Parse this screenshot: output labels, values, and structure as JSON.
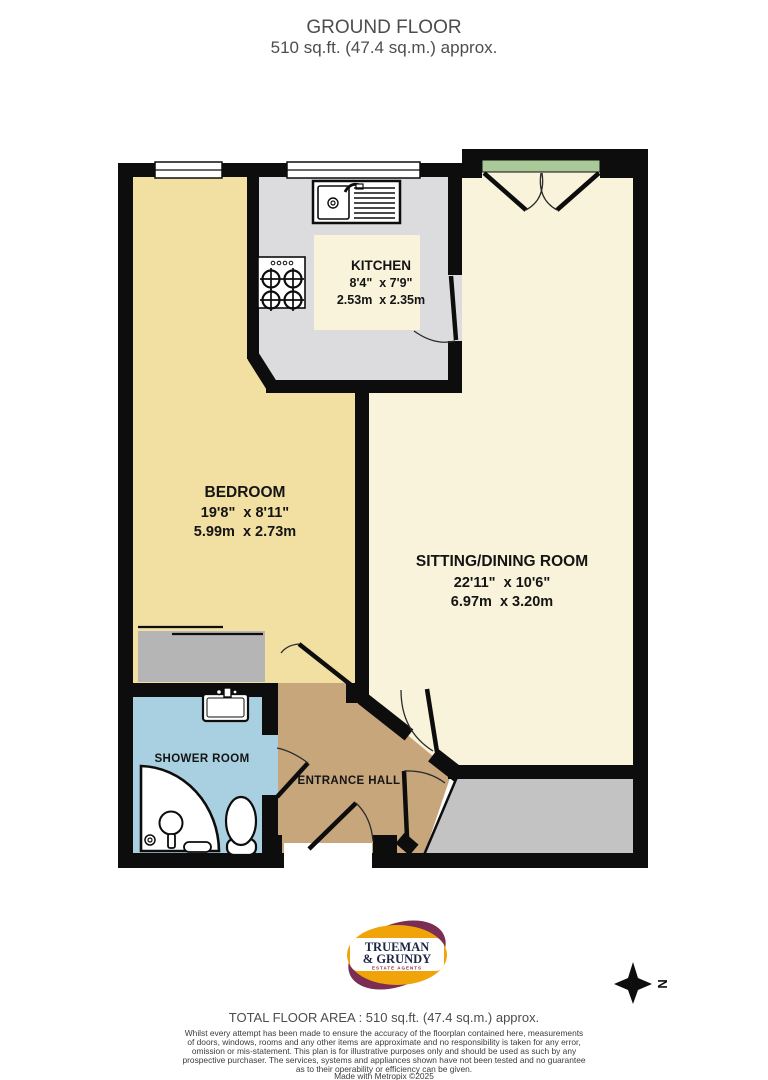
{
  "title": {
    "line1": "GROUND FLOOR",
    "line2": "510 sq.ft. (47.4 sq.m.) approx."
  },
  "rooms": {
    "kitchen": {
      "name": "KITCHEN",
      "imperial": "8'4\"  x 7'9\"",
      "metric": "2.53m  x 2.35m"
    },
    "bedroom": {
      "name": "BEDROOM",
      "imperial": "19'8\"  x 8'11\"",
      "metric": "5.99m  x 2.73m"
    },
    "sitting": {
      "name": "SITTING/DINING ROOM",
      "imperial": "22'11\"  x 10'6\"",
      "metric": "6.97m  x 3.20m"
    },
    "shower": {
      "name": "SHOWER ROOM"
    },
    "hall": {
      "name": "ENTRANCE HALL"
    }
  },
  "compass": {
    "label": "N"
  },
  "logo": {
    "name_line1": "TRUEMAN",
    "name_line2": "& GRUNDY",
    "tagline": "ESTATE AGENTS"
  },
  "footer": {
    "total_area": "TOTAL FLOOR AREA : 510 sq.ft. (47.4 sq.m.) approx.",
    "disclaimer": [
      "Whilst every attempt has been made to ensure the accuracy of the floorplan contained here, measurements",
      "of doors, windows, rooms and any other items are approximate and no responsibility is taken for any error,",
      "omission or mis-statement. This plan is for illustrative purposes only and should be used as such by any",
      "prospective purchaser. The services, systems and appliances shown have not been tested and no guarantee",
      "as to their operability or efficiency can be given."
    ],
    "credit": "Made with Metropix ©2025"
  },
  "colors": {
    "wall": "#0d0d0d",
    "bedroom_floor": "#f2dfa2",
    "sitting_floor": "#f8f3da",
    "kitchen_counter": "#dcdcdf",
    "kitchen_floor": "#f8f3da",
    "shower_floor": "#a9d0e0",
    "hall_floor": "#c8a67c",
    "storage_gray": "#c3c3c4",
    "wardrobe_gray": "#b5b5b5",
    "garden_green": "#a9c998",
    "logo_gold": "#f0a40a",
    "logo_purple": "#7b2d54"
  }
}
